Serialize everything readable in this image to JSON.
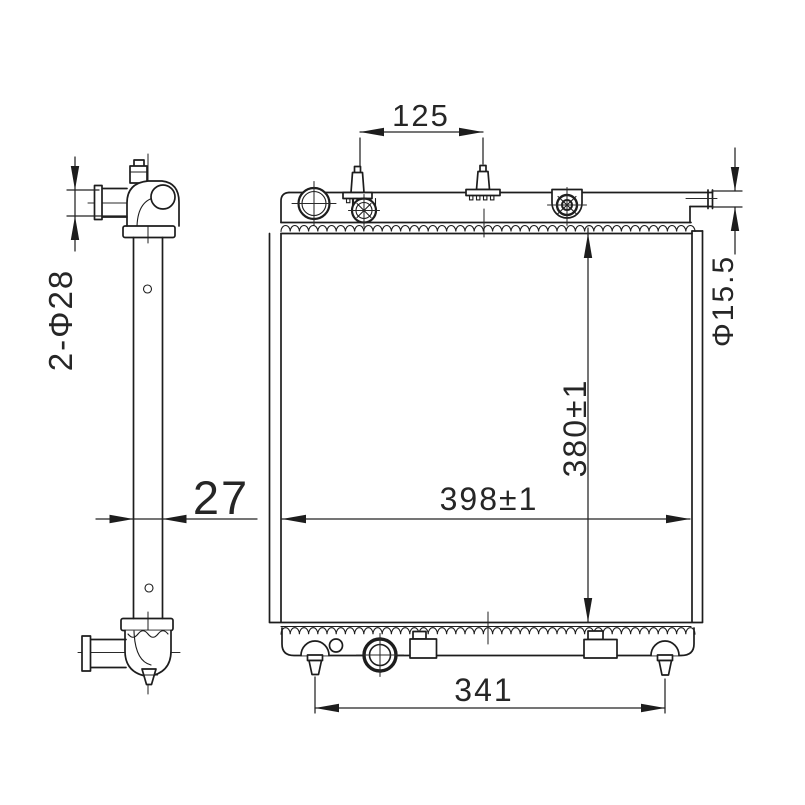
{
  "drawing": {
    "background": "#ffffff",
    "line_color": "#1d1d1d",
    "dims": {
      "pin_spacing_top": {
        "label": "125"
      },
      "inlet_ports": {
        "label": "2-Φ28"
      },
      "depth": {
        "label": "27"
      },
      "core_width": {
        "label": "398±1"
      },
      "core_height": {
        "label": "380±1"
      },
      "outlet_diameter": {
        "label": "Φ15.5"
      },
      "pin_spacing_bottom": {
        "label": "341"
      }
    }
  }
}
